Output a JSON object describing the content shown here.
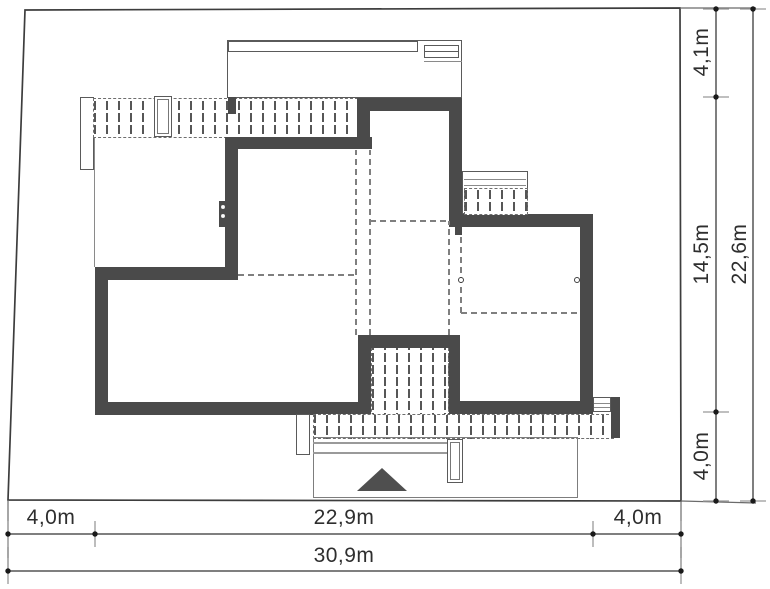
{
  "drawing": {
    "kind": "site-plan",
    "colors": {
      "wall": "#4a4a4a",
      "plot_line": "#3d3d3d",
      "dashed_line": "#7f7f7f",
      "dimension_line": "#555555",
      "text": "#2e2e2e",
      "background": "#ffffff"
    },
    "icons": {
      "entrance_arrow": "triangle-up"
    }
  },
  "dimensions": {
    "bottom": [
      {
        "label": "4,0m"
      },
      {
        "label": "22,9m"
      },
      {
        "label": "4,0m"
      },
      {
        "label": "30,9m"
      }
    ],
    "right": [
      {
        "label": "4,1m"
      },
      {
        "label": "14,5m"
      },
      {
        "label": "4,0m"
      },
      {
        "label": "22,6m"
      }
    ]
  }
}
